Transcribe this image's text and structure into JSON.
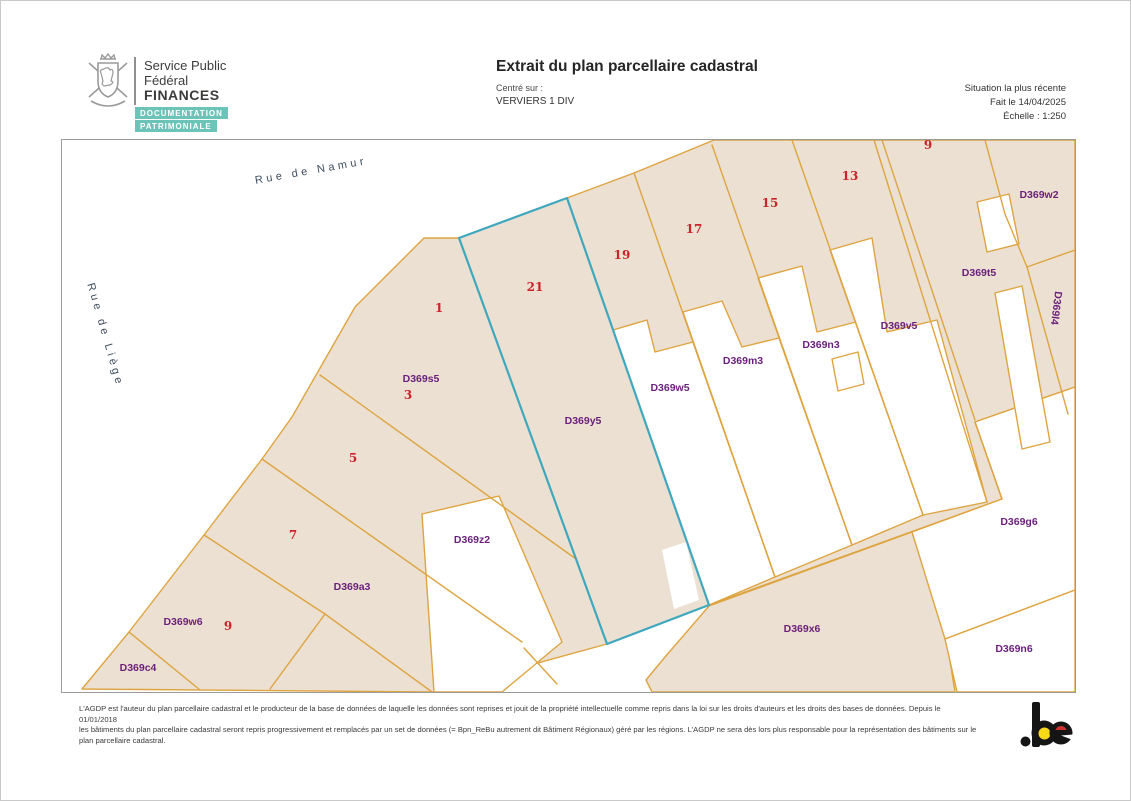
{
  "header": {
    "org_line1": "Service Public",
    "org_line2": "Fédéral",
    "org_line3": "FINANCES",
    "badge1": "DOCUMENTATION",
    "badge2": "PATRIMONIALE",
    "title": "Extrait du plan parcellaire cadastral",
    "centered_on_label": "Centré sur :",
    "centered_on_value": "VERVIERS 1 DIV",
    "situation": "Situation la plus récente",
    "date": "Fait le 14/04/2025",
    "scale": "Échelle : 1:250"
  },
  "map": {
    "labels": [
      {
        "text": "Rue de Namur",
        "type": "street",
        "x": 309,
        "y": 169,
        "rot": -10
      },
      {
        "text": "Rue de Liège",
        "type": "street",
        "x": 103,
        "y": 333,
        "rot": 74
      },
      {
        "text": "1",
        "type": "number",
        "x": 437,
        "y": 306,
        "rot": 0
      },
      {
        "text": "21",
        "type": "number",
        "x": 533,
        "y": 285,
        "rot": 0
      },
      {
        "text": "3",
        "type": "number",
        "x": 406,
        "y": 393,
        "rot": 0
      },
      {
        "text": "19",
        "type": "number",
        "x": 620,
        "y": 253,
        "rot": 0
      },
      {
        "text": "17",
        "type": "number",
        "x": 692,
        "y": 227,
        "rot": 0
      },
      {
        "text": "15",
        "type": "number",
        "x": 768,
        "y": 201,
        "rot": 0
      },
      {
        "text": "13",
        "type": "number",
        "x": 848,
        "y": 174,
        "rot": 0
      },
      {
        "text": "9",
        "type": "number",
        "x": 926,
        "y": 143,
        "rot": 0
      },
      {
        "text": "5",
        "type": "number",
        "x": 351,
        "y": 456,
        "rot": 0
      },
      {
        "text": "7",
        "type": "number",
        "x": 291,
        "y": 533,
        "rot": 0
      },
      {
        "text": "9",
        "type": "number",
        "x": 226,
        "y": 624,
        "rot": 0
      },
      {
        "text": "D369s5",
        "type": "parcel",
        "x": 419,
        "y": 377,
        "rot": 0
      },
      {
        "text": "D369y5",
        "type": "parcel",
        "x": 581,
        "y": 419,
        "rot": 0
      },
      {
        "text": "D369w5",
        "type": "parcel",
        "x": 668,
        "y": 386,
        "rot": 0
      },
      {
        "text": "D369m3",
        "type": "parcel",
        "x": 741,
        "y": 359,
        "rot": 0
      },
      {
        "text": "D369n3",
        "type": "parcel",
        "x": 819,
        "y": 343,
        "rot": 0
      },
      {
        "text": "D369v5",
        "type": "parcel",
        "x": 897,
        "y": 324,
        "rot": 0
      },
      {
        "text": "D369w2",
        "type": "parcel",
        "x": 1037,
        "y": 193,
        "rot": 0
      },
      {
        "text": "D369t5",
        "type": "parcel",
        "x": 977,
        "y": 271,
        "rot": 0
      },
      {
        "text": "D369l4",
        "type": "parcel",
        "x": 1054,
        "y": 306,
        "rot": 97
      },
      {
        "text": "D369z2",
        "type": "parcel",
        "x": 470,
        "y": 538,
        "rot": 0
      },
      {
        "text": "D369a3",
        "type": "parcel",
        "x": 350,
        "y": 585,
        "rot": 0
      },
      {
        "text": "D369w6",
        "type": "parcel",
        "x": 181,
        "y": 620,
        "rot": 0
      },
      {
        "text": "D369c4",
        "type": "parcel",
        "x": 136,
        "y": 666,
        "rot": 0
      },
      {
        "text": "D369x6",
        "type": "parcel",
        "x": 800,
        "y": 627,
        "rot": 0
      },
      {
        "text": "D369g6",
        "type": "parcel",
        "x": 1017,
        "y": 520,
        "rot": 0
      },
      {
        "text": "D369n6",
        "type": "parcel",
        "x": 1012,
        "y": 647,
        "rot": 0
      }
    ],
    "colors": {
      "parcel_fill": "#ebe0d1",
      "parcel_border": "#dea440",
      "selected_border": "#3fa8be",
      "parcel_id_text": "#6b1f7c",
      "house_number_text": "#cc2229",
      "street_text": "#3e4e5e"
    }
  },
  "footer": {
    "lines": [
      "L'AGDP est l'auteur du plan parcellaire cadastral et le producteur de la base de données de laquelle les données sont reprises et jouit de la propriété intellectuelle comme repris dans la loi sur les droits d'auteurs et les droits des bases de données. Depuis le 01/01/2018",
      "les bâtiments du plan parcellaire cadastral seront repris progressivement et remplacés par un set de données (= Bpn_ReBu autrement dit Bâtiment Régionaux) géré par les régions. L'AGDP ne sera dès lors plus responsable pour la représentation des bâtiments sur le",
      "plan parcellaire cadastral."
    ],
    "logo_text": ".be",
    "badge_color": "#6cc3b8"
  }
}
